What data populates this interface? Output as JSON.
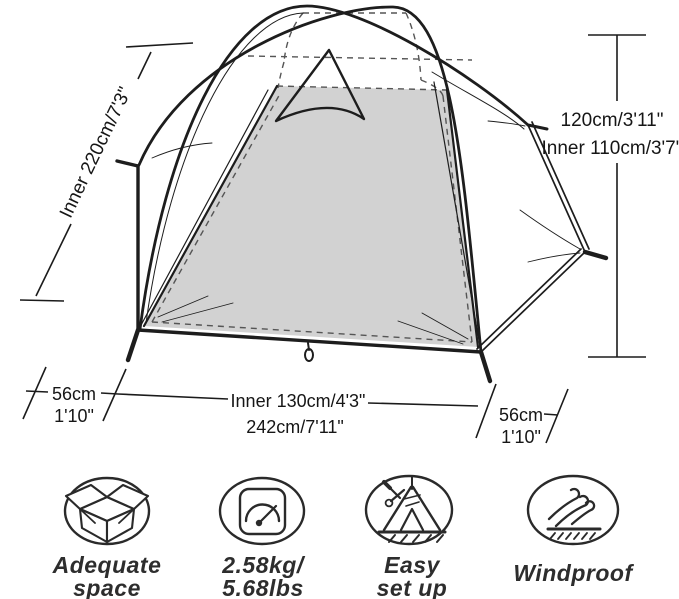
{
  "title": "tent-dimension-diagram",
  "dimensions": {
    "left_diagonal": "Inner 220cm/7'3\"",
    "right_height": "120cm/3'11\"",
    "right_inner_height": "Inner 110cm/3'7\"",
    "bottom_left_vestibule_cm": "56cm",
    "bottom_left_vestibule_ft": "1'10\"",
    "bottom_inner_width": "Inner 130cm/4'3\"",
    "bottom_total_width": "242cm/7'11\"",
    "bottom_right_vestibule_cm": "56cm",
    "bottom_right_vestibule_ft": "1'10\""
  },
  "features": [
    {
      "icon": "open-box-icon",
      "line1": "Adequate",
      "line2": "space"
    },
    {
      "icon": "weight-scale-icon",
      "line1": "2.58kg/",
      "line2": "5.68lbs"
    },
    {
      "icon": "tent-setup-icon",
      "line1": "Easy",
      "line2": "set up"
    },
    {
      "icon": "windproof-icon",
      "line1": "Windproof",
      "line2": ""
    }
  ],
  "colors": {
    "line": "#1d1d1d",
    "panel_gray": "#d2d2d2",
    "dash_gray": "#555555",
    "text": "#161616",
    "label": "#2d2d2d"
  }
}
